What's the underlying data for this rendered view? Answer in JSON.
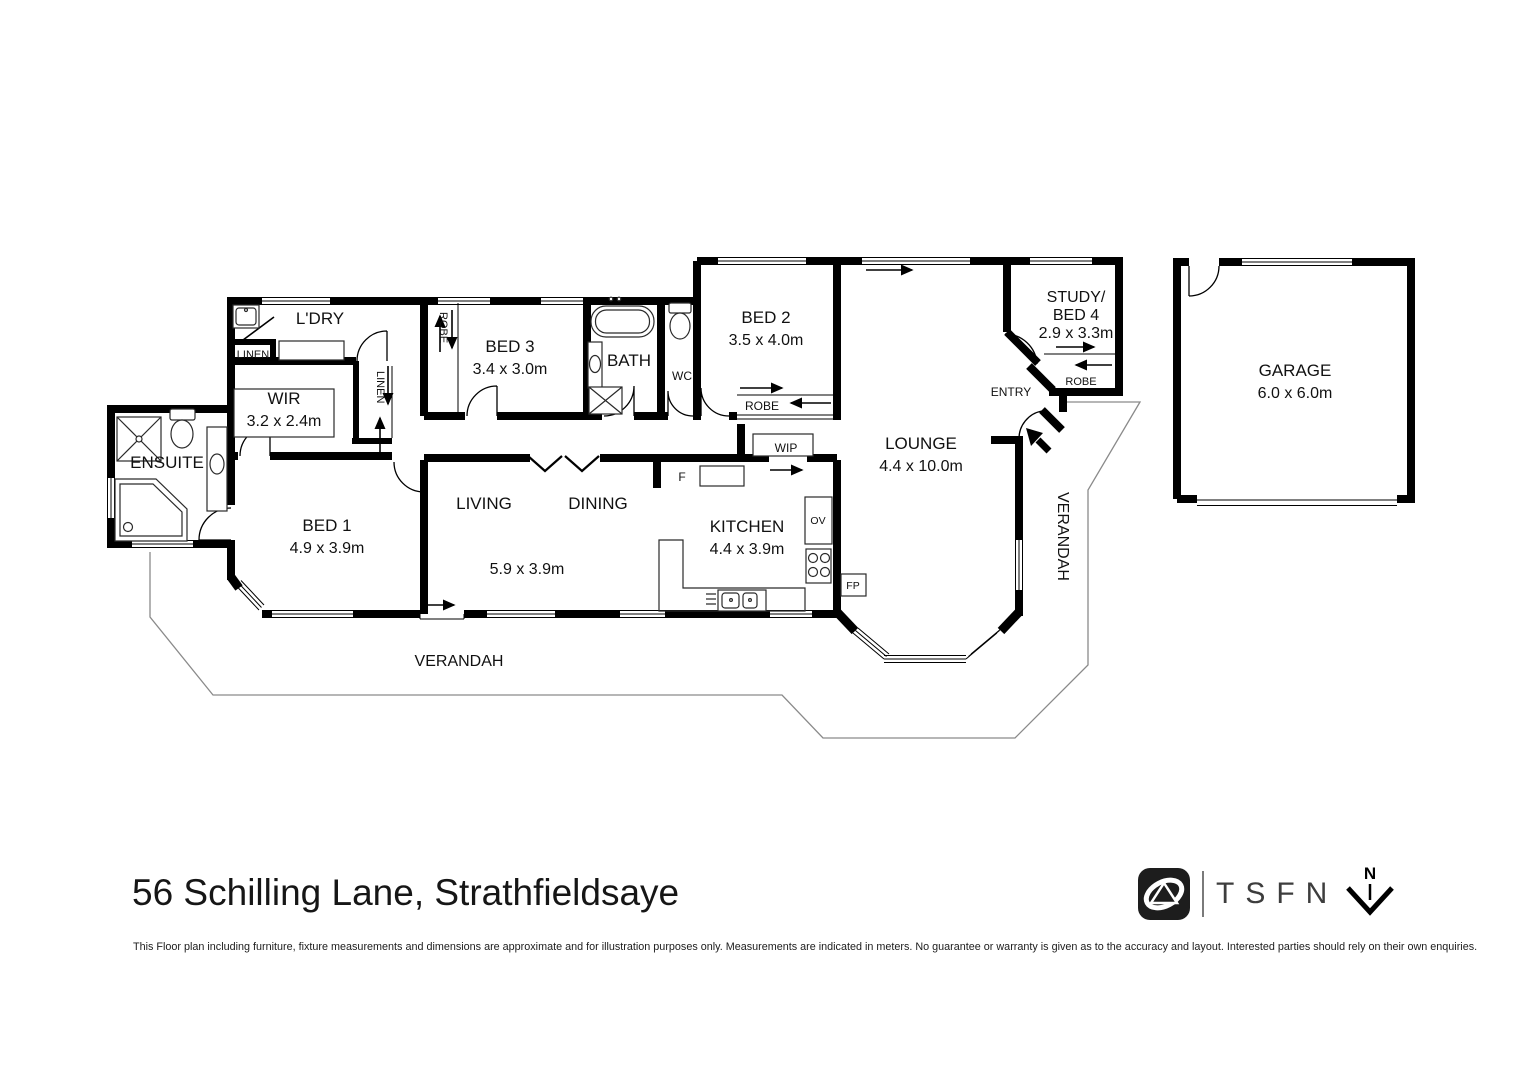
{
  "title": "56 Schilling Lane, Strathfieldsaye",
  "disclaimer": "This Floor plan including furniture, fixture measurements and dimensions are approximate and for illustration purposes only. Measurements are indicated in meters. No guarantee or warranty is given as to the accuracy and layout. Interested parties should rely on their own enquiries.",
  "branding": {
    "logo_text": "TSFN",
    "north_label": "N"
  },
  "colors": {
    "wall": "#000000",
    "text": "#111111",
    "verandah_outline": "#8a8a8a"
  },
  "rooms": {
    "ldry": {
      "label": "L'DRY"
    },
    "linen1": {
      "label": "LINEN"
    },
    "linen2": {
      "label": "LINEN"
    },
    "wir": {
      "label": "WIR",
      "dims": "3.2 x 2.4m"
    },
    "ensuite": {
      "label": "ENSUITE"
    },
    "bed1": {
      "label": "BED 1",
      "dims": "4.9 x 3.9m"
    },
    "bed3": {
      "label": "BED 3",
      "dims": "3.4 x 3.0m"
    },
    "robe_bed3": {
      "label": "ROBE"
    },
    "bath": {
      "label": "BATH"
    },
    "wc": {
      "label": "WC"
    },
    "bed2": {
      "label": "BED 2",
      "dims": "3.5 x 4.0m"
    },
    "robe_bed2": {
      "label": "ROBE"
    },
    "wip": {
      "label": "WIP"
    },
    "fridge": {
      "label": "F"
    },
    "kitchen": {
      "label": "KITCHEN",
      "dims": "4.4 x 3.9m"
    },
    "oven": {
      "label": "OV"
    },
    "fireplace": {
      "label": "FP"
    },
    "living": {
      "label": "LIVING"
    },
    "dining": {
      "label": "DINING"
    },
    "living_dining_dims": {
      "label": "5.9 x 3.9m"
    },
    "lounge": {
      "label": "LOUNGE",
      "dims": "4.4 x 10.0m"
    },
    "study": {
      "line1": "STUDY/",
      "line2": "BED 4",
      "dims": "2.9 x 3.3m"
    },
    "robe_study": {
      "label": "ROBE"
    },
    "entry": {
      "label": "ENTRY"
    },
    "garage": {
      "label": "GARAGE",
      "dims": "6.0 x 6.0m"
    },
    "verandah_south": {
      "label": "VERANDAH"
    },
    "verandah_east": {
      "label": "VERANDAH"
    }
  }
}
